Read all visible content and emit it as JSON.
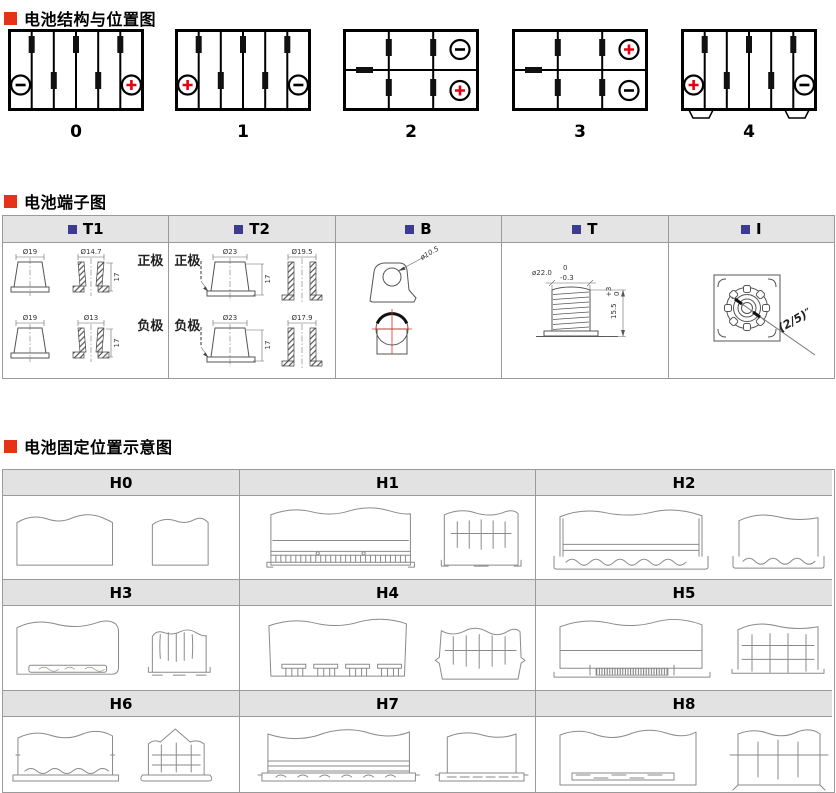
{
  "colors": {
    "bullet_red": "#e43317",
    "plus_red": "#e60012",
    "header_square_blue": "#3c3b90",
    "table_header_bg": "#e4e4e4",
    "table_border": "#9a9a9a"
  },
  "section1": {
    "title": "电池结构与位置图",
    "batteries": [
      {
        "label": "0",
        "layout": "6-cell",
        "left_terminal": "negative",
        "right_terminal": "positive"
      },
      {
        "label": "1",
        "layout": "6-cell",
        "left_terminal": "positive",
        "right_terminal": "negative"
      },
      {
        "label": "2",
        "layout": "2x3-grid",
        "top_right_terminal": "negative",
        "bottom_right_terminal": "positive"
      },
      {
        "label": "3",
        "layout": "2x3-grid",
        "top_right_terminal": "positive",
        "bottom_right_terminal": "negative"
      },
      {
        "label": "4",
        "layout": "6-cell-flanged",
        "left_terminal": "positive",
        "right_terminal": "negative"
      }
    ]
  },
  "section2": {
    "title": "电池端子图",
    "columns": [
      {
        "label": "T1",
        "rows": [
          {
            "polarity": "正极",
            "front_dia": "Ø19",
            "section_dia": "Ø14.7",
            "height": "17"
          },
          {
            "polarity": "负极",
            "front_dia": "Ø19",
            "section_dia": "Ø13",
            "height": "17"
          }
        ]
      },
      {
        "label": "T2",
        "rows": [
          {
            "polarity": "正极",
            "front_dia": "Ø23",
            "section_dia": "Ø19.5",
            "height": "17"
          },
          {
            "polarity": "负极",
            "front_dia": "Ø23",
            "section_dia": "Ø17.9",
            "height": "17"
          }
        ]
      },
      {
        "label": "B",
        "hole_dia": "ø10.5"
      },
      {
        "label": "T",
        "dia": "ø22.0",
        "dia_tol_upper": "0",
        "dia_tol_lower": "-0.3",
        "height": "15.5",
        "height_tol_upper": "+3",
        "height_tol_lower": "0"
      },
      {
        "label": "I",
        "thread": "(2/5)″"
      }
    ]
  },
  "section3": {
    "title": "电池固定位置示意图",
    "cells": [
      {
        "label": "H0"
      },
      {
        "label": "H1"
      },
      {
        "label": "H2"
      },
      {
        "label": "H3"
      },
      {
        "label": "H4"
      },
      {
        "label": "H5"
      },
      {
        "label": "H6"
      },
      {
        "label": "H7"
      },
      {
        "label": "H8"
      }
    ]
  }
}
